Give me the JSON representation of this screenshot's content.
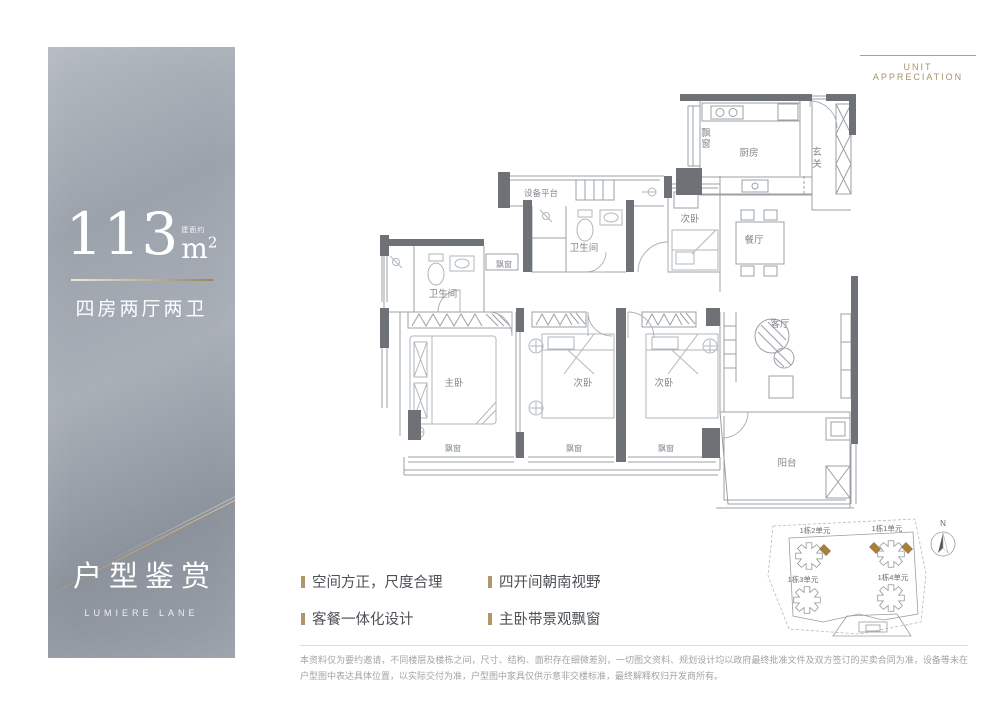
{
  "left_panel": {
    "area_value": "113",
    "area_prefix": "建面约",
    "area_unit": "m",
    "area_exponent": "2",
    "layout_label": "四房两厅两卫",
    "title": "户型鉴赏",
    "subtitle": "LUMIERE LANE"
  },
  "header": {
    "tagline": "UNIT APPRECIATION"
  },
  "floorplan": {
    "vertical_labels": {
      "kitchen_bay": [
        "飘",
        "窗"
      ],
      "entry": [
        "玄",
        "关"
      ]
    },
    "labels": [
      "厨房",
      "设备平台",
      "卫生间",
      "次卧",
      "餐厅",
      "飘窗",
      "卫生间",
      "主卧",
      "次卧",
      "次卧",
      "客厅",
      "阳台",
      "飘窗",
      "飘窗",
      "飘窗"
    ]
  },
  "features": {
    "items": [
      "空间方正，尺度合理",
      "四开间朝南视野",
      "客餐一体化设计",
      "主卧带景观飘窗"
    ]
  },
  "siteplan": {
    "units": [
      "1栋2单元",
      "1栋1单元",
      "1栋3单元",
      "1栋4单元"
    ],
    "compass_label": "N"
  },
  "disclaimer": {
    "line": "本资料仅为要约邀请，不同楼层及楼栋之间，尺寸、结构、面积存在细微差别，一切图文资料、规划设计均以政府最终批准文件及双方签订的买卖合同为准，设备等未在户型图中表达具体位置，以实际交付为准，户型图中家具仅供示意非交楼标准，最终解释权归开发商所有。"
  },
  "colors": {
    "gold": "#b3956a",
    "wall": "#6e7276",
    "plan_line": "#9aa0a6",
    "site_highlight": "#a57f3f"
  }
}
